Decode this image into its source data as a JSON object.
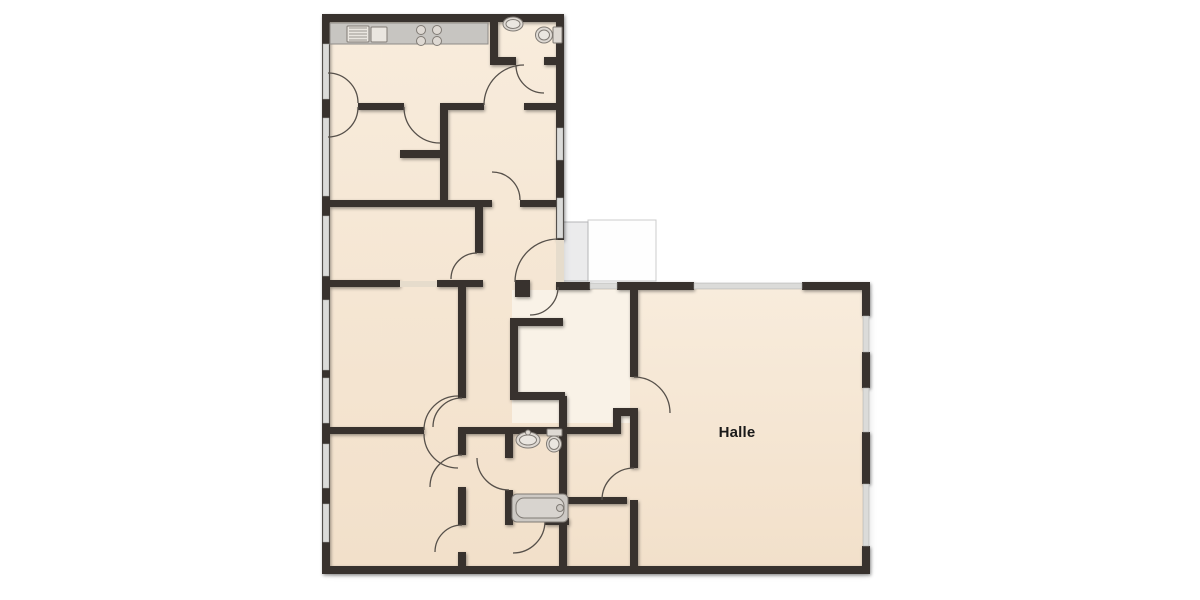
{
  "room_label": {
    "text": "Halle"
  },
  "colors": {
    "floor": "#f5e6d1",
    "floor_light": "#f9f2e7",
    "wall": "#38322d",
    "window": "#dbdbd9",
    "threshold": "#e6dccc",
    "arc": "#56504a",
    "porch_fill": "#ebebec",
    "porch_stroke": "#b4b5b7",
    "terrace_fill": "#fefefe",
    "terrace_stroke": "#cccccc",
    "fixture_fill": "#ded9d3",
    "fixture_inner": "#eae6e0",
    "fixture_stroke": "#807b75",
    "counter_fill": "#c7c5c1",
    "counter_stroke": "#8f8c88",
    "tub_fill": "#cdc9c4",
    "tub_inner": "#d8d4cf",
    "text": "#1a1a1a"
  },
  "plan": {
    "floors": [
      {
        "x": 326,
        "y": 18,
        "w": 234,
        "h": 552,
        "fill": "floor"
      },
      {
        "x": 560,
        "y": 286,
        "w": 306,
        "h": 284,
        "fill": "floor"
      },
      {
        "x": 512,
        "y": 290,
        "w": 118,
        "h": 133,
        "fill": "floor_light"
      }
    ],
    "porch": {
      "x": 562,
      "y": 222,
      "w": 26,
      "h": 59
    },
    "terrace": {
      "x": 588,
      "y": 220,
      "w": 68,
      "h": 61
    },
    "walls": [
      [
        322,
        14,
        242,
        8
      ],
      [
        322,
        14,
        8,
        560
      ],
      [
        322,
        566,
        548,
        8
      ],
      [
        556,
        14,
        8,
        226
      ],
      [
        556,
        282,
        8,
        8
      ],
      [
        556,
        282,
        34,
        8
      ],
      [
        617,
        282,
        77,
        8
      ],
      [
        802,
        282,
        68,
        8
      ],
      [
        862,
        282,
        8,
        34
      ],
      [
        862,
        352,
        8,
        36
      ],
      [
        862,
        432,
        8,
        52
      ],
      [
        862,
        546,
        8,
        28
      ],
      [
        490,
        22,
        8,
        43
      ],
      [
        490,
        57,
        26,
        8
      ],
      [
        544,
        57,
        20,
        8
      ],
      [
        358,
        103,
        46,
        7
      ],
      [
        440,
        103,
        44,
        7
      ],
      [
        524,
        103,
        40,
        7
      ],
      [
        440,
        110,
        8,
        94
      ],
      [
        400,
        150,
        48,
        8
      ],
      [
        330,
        200,
        118,
        7
      ],
      [
        448,
        200,
        44,
        7
      ],
      [
        520,
        200,
        44,
        7
      ],
      [
        475,
        207,
        8,
        46
      ],
      [
        330,
        280,
        70,
        7
      ],
      [
        437,
        280,
        46,
        7
      ],
      [
        515,
        280,
        15,
        17
      ],
      [
        458,
        287,
        8,
        111
      ],
      [
        510,
        318,
        53,
        8
      ],
      [
        510,
        318,
        8,
        78
      ],
      [
        510,
        392,
        55,
        8
      ],
      [
        559,
        396,
        8,
        40
      ],
      [
        330,
        427,
        94,
        7
      ],
      [
        458,
        427,
        156,
        7
      ],
      [
        613,
        408,
        8,
        26
      ],
      [
        613,
        408,
        25,
        8
      ],
      [
        630,
        282,
        8,
        95
      ],
      [
        630,
        413,
        8,
        55
      ],
      [
        630,
        500,
        8,
        74
      ],
      [
        458,
        434,
        8,
        21
      ],
      [
        458,
        487,
        8,
        38
      ],
      [
        458,
        552,
        8,
        14
      ],
      [
        505,
        434,
        8,
        24
      ],
      [
        505,
        490,
        8,
        28
      ],
      [
        505,
        518,
        8,
        7
      ],
      [
        545,
        518,
        24,
        7
      ],
      [
        559,
        434,
        8,
        132
      ],
      [
        567,
        497,
        60,
        7
      ]
    ],
    "windows": [
      [
        323,
        44,
        6,
        55
      ],
      [
        323,
        118,
        6,
        78
      ],
      [
        323,
        216,
        6,
        60
      ],
      [
        323,
        300,
        6,
        70
      ],
      [
        323,
        378,
        6,
        45
      ],
      [
        323,
        444,
        6,
        44
      ],
      [
        323,
        504,
        6,
        38
      ],
      [
        557,
        128,
        6,
        32
      ],
      [
        557,
        198,
        6,
        40
      ],
      [
        590,
        283,
        27,
        6
      ],
      [
        694,
        283,
        108,
        6
      ],
      [
        863,
        316,
        6,
        36
      ],
      [
        863,
        388,
        6,
        44
      ],
      [
        863,
        484,
        6,
        62
      ]
    ],
    "thresholds": [
      [
        400,
        281,
        37,
        6
      ],
      [
        556,
        240,
        8,
        42
      ]
    ],
    "door_arcs": [
      "M 358,103 A 30 30 0 0 0 328,73",
      "M 358,107 A 30 30 0 0 1 328,137",
      "M 484,105 A 40 40 0 0 1 524,65",
      "M 516,65 A 28 28 0 0 0 544,93",
      "M 404,107 A 36 36 0 0 0 440,143",
      "M 492,172 A 28 28 0 0 1 520,200",
      "M 477,253 A 26 26 0 0 0 451,279",
      "M 558,287 A 28 28 0 0 1 530,315",
      "M 515,282 A 43 43 0 0 1 558,239",
      "M 462,398 A 29 29 0 0 0 433,427",
      "M 424,430 A 34 34 0 0 1 458,396",
      "M 424,434 A 34 34 0 0 0 458,468",
      "M 462,455 A 32 32 0 0 0 430,487",
      "M 462,525 A 27 27 0 0 0 435,552",
      "M 509,490 A 32 32 0 0 1 477,458",
      "M 545,521 A 32 32 0 0 1 513,553",
      "M 634,377 A 36 36 0 0 1 670,413",
      "M 634,468 A 32 32 0 0 0 602,500"
    ],
    "fixtures": [
      {
        "name": "kitchen-counter",
        "type": "rect",
        "x": 330,
        "y": 23,
        "w": 158,
        "h": 21,
        "rx": 0,
        "fill": "counter_fill",
        "stroke": "counter_stroke"
      },
      {
        "name": "kitchen-sink-drainer",
        "type": "rect",
        "x": 347,
        "y": 26,
        "w": 22,
        "h": 16,
        "rx": 1,
        "fill": "fixture_inner",
        "stroke": "fixture_stroke"
      },
      {
        "name": "kitchen-sink-drainer-line",
        "type": "line",
        "x1": 349,
        "y1": 28,
        "x2": 367,
        "y2": 28
      },
      {
        "name": "kitchen-sink-drainer-line",
        "type": "line",
        "x1": 349,
        "y1": 31,
        "x2": 367,
        "y2": 31
      },
      {
        "name": "kitchen-sink-drainer-line",
        "type": "line",
        "x1": 349,
        "y1": 34,
        "x2": 367,
        "y2": 34
      },
      {
        "name": "kitchen-sink-drainer-line",
        "type": "line",
        "x1": 349,
        "y1": 37,
        "x2": 367,
        "y2": 37
      },
      {
        "name": "kitchen-sink-drainer-line",
        "type": "line",
        "x1": 349,
        "y1": 40,
        "x2": 367,
        "y2": 40
      },
      {
        "name": "kitchen-sink-basin",
        "type": "rect",
        "x": 371,
        "y": 27,
        "w": 16,
        "h": 15,
        "rx": 1,
        "fill": "fixture_inner",
        "stroke": "fixture_stroke"
      },
      {
        "name": "stove-burner",
        "type": "circle",
        "cx": 421,
        "cy": 30,
        "r": 4.5,
        "fill": "fixture_fill",
        "stroke": "fixture_stroke"
      },
      {
        "name": "stove-burner",
        "type": "circle",
        "cx": 437,
        "cy": 30,
        "r": 4.5,
        "fill": "fixture_fill",
        "stroke": "fixture_stroke"
      },
      {
        "name": "stove-burner",
        "type": "circle",
        "cx": 421,
        "cy": 41,
        "r": 4.5,
        "fill": "fixture_fill",
        "stroke": "fixture_stroke"
      },
      {
        "name": "stove-burner",
        "type": "circle",
        "cx": 437,
        "cy": 41,
        "r": 4.5,
        "fill": "fixture_fill",
        "stroke": "fixture_stroke"
      },
      {
        "name": "wc-sink",
        "type": "ellipse",
        "cx": 513,
        "cy": 24,
        "rx": 10,
        "ry": 7,
        "fill": "fixture_fill",
        "stroke": "fixture_stroke"
      },
      {
        "name": "wc-sink-basin",
        "type": "ellipse",
        "cx": 513,
        "cy": 24,
        "rx": 7,
        "ry": 4.5,
        "fill": "fixture_inner",
        "stroke": "fixture_stroke"
      },
      {
        "name": "wc-toilet-tank",
        "type": "rect",
        "x": 553,
        "y": 27,
        "w": 9,
        "h": 16,
        "rx": 1,
        "fill": "fixture_fill",
        "stroke": "fixture_stroke"
      },
      {
        "name": "wc-toilet-bowl",
        "type": "ellipse",
        "cx": 544,
        "cy": 35,
        "rx": 8.5,
        "ry": 8,
        "fill": "fixture_fill",
        "stroke": "fixture_stroke"
      },
      {
        "name": "wc-toilet-bowl-inner",
        "type": "ellipse",
        "cx": 544,
        "cy": 35,
        "rx": 5.5,
        "ry": 5,
        "fill": "fixture_inner",
        "stroke": "fixture_stroke"
      },
      {
        "name": "bath-sink",
        "type": "ellipse",
        "cx": 528,
        "cy": 440,
        "rx": 12,
        "ry": 8,
        "fill": "fixture_fill",
        "stroke": "fixture_stroke"
      },
      {
        "name": "bath-sink-basin",
        "type": "ellipse",
        "cx": 528,
        "cy": 440,
        "rx": 8.5,
        "ry": 5,
        "fill": "fixture_inner",
        "stroke": "fixture_stroke"
      },
      {
        "name": "bath-sink-tap",
        "type": "circle",
        "cx": 528,
        "cy": 432.5,
        "r": 2.5,
        "fill": "fixture_fill",
        "stroke": "fixture_stroke"
      },
      {
        "name": "bath-toilet-tank",
        "type": "rect",
        "x": 547,
        "y": 429,
        "w": 15,
        "h": 7,
        "rx": 1,
        "fill": "fixture_fill",
        "stroke": "fixture_stroke"
      },
      {
        "name": "bath-toilet-bowl",
        "type": "ellipse",
        "cx": 554,
        "cy": 444,
        "rx": 7.5,
        "ry": 8,
        "fill": "fixture_fill",
        "stroke": "fixture_stroke"
      },
      {
        "name": "bath-toilet-bowl-inner",
        "type": "ellipse",
        "cx": 554,
        "cy": 444,
        "rx": 5,
        "ry": 5.5,
        "fill": "fixture_inner",
        "stroke": "fixture_stroke"
      },
      {
        "name": "bathtub",
        "type": "rect",
        "x": 512,
        "y": 494,
        "w": 56,
        "h": 28,
        "rx": 5,
        "fill": "tub_fill",
        "stroke": "fixture_stroke"
      },
      {
        "name": "bathtub-inner",
        "type": "rect",
        "x": 516,
        "y": 498,
        "w": 48,
        "h": 20,
        "rx": 8,
        "fill": "tub_inner",
        "stroke": "fixture_stroke"
      },
      {
        "name": "bathtub-faucet",
        "type": "circle",
        "cx": 560,
        "cy": 508,
        "r": 3.5,
        "fill": "tub_fill",
        "stroke": "fixture_stroke"
      }
    ]
  }
}
